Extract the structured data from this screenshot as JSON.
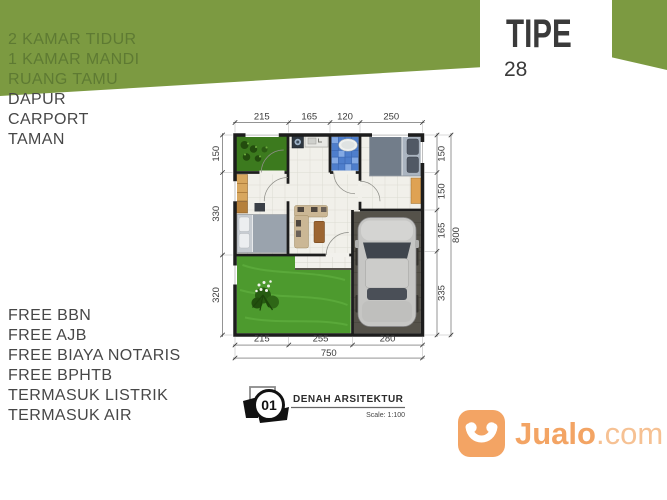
{
  "type_card": {
    "label": "TIPE",
    "number": "28"
  },
  "features_top": [
    "2 KAMAR TIDUR",
    "1 KAMAR MANDI",
    "RUANG TAMU",
    "DAPUR",
    "CARPORT",
    "TAMAN"
  ],
  "features_bottom": [
    "FREE BBN",
    "FREE AJB",
    "FREE BIAYA NOTARIS",
    "FREE BPHTB",
    "TERMASUK LISTRIK",
    "TERMASUK AIR"
  ],
  "plan": {
    "dims": {
      "top": [
        "215",
        "165",
        "120",
        "250"
      ],
      "left": [
        "150",
        "330",
        "320"
      ],
      "right": [
        "150",
        "150",
        "165",
        "335"
      ],
      "right_total": "800",
      "bottom": [
        "215",
        "255",
        "280"
      ],
      "bottom_total": "750"
    }
  },
  "titleblock": {
    "number": "01",
    "title": "DENAH ARSITEKTUR",
    "scale": "Scale: 1:100"
  },
  "watermark": {
    "brand_bold": "Jualo",
    "brand_suffix": ".com"
  },
  "colors": {
    "banner_green": "#7c9a41",
    "banner_text_green": "#5e7a33",
    "text_dark": "#474747",
    "jualo_orange": "#f3a464",
    "lawn_green": "#4d9a2e",
    "bath_blue": "#4e7ecc",
    "wall_black": "#1d1d1d"
  }
}
